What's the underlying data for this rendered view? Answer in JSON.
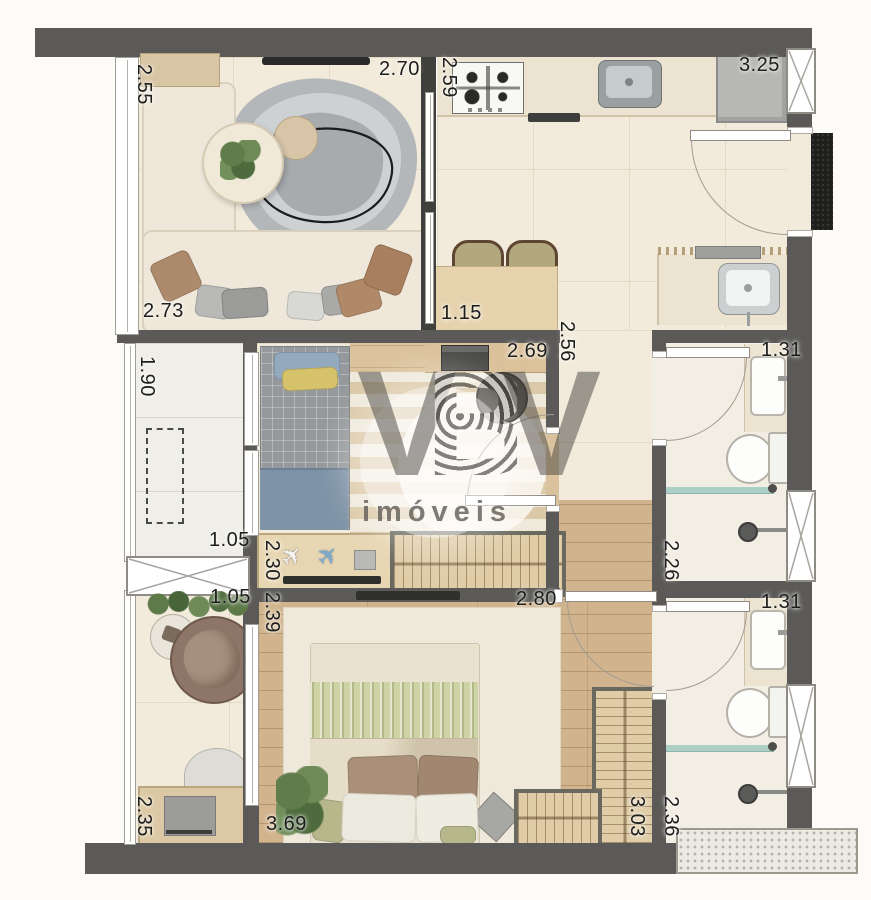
{
  "watermark": {
    "letters": [
      "V",
      "B",
      "V"
    ],
    "subtitle": "imóveis"
  },
  "icons": {
    "toy_plane": "✈"
  },
  "dimensions": {
    "living_top": "2.70",
    "living_left": "2.55",
    "living_bottom": "2.73",
    "kitchen_left": "2.59",
    "kitchen_top": "3.25",
    "dining": "1.15",
    "hall_right": "2.56",
    "bedroom2_top": "2.69",
    "bedroom2_left": "2.30",
    "balcony_left": "1.90",
    "balcony_bottom": "1.05",
    "office_top": "1.05",
    "office_left": "2.35",
    "master_left": "2.39",
    "master_top": "2.80",
    "master_bottom": "3.69",
    "wardrobe_right": "3.03",
    "bath1_top": "1.31",
    "bath1_left": "2.26",
    "bath2_top": "1.31",
    "bath2_left": "2.36"
  },
  "colors": {
    "wall": "#5b5a58",
    "floor_tile": "#f2ebdb",
    "wood_floor": "#d1b48d",
    "counter": "#ece3d0",
    "glass_partition": "#accfc6",
    "watermark_gray": "#464440",
    "doormat": "#1f1f1d"
  }
}
